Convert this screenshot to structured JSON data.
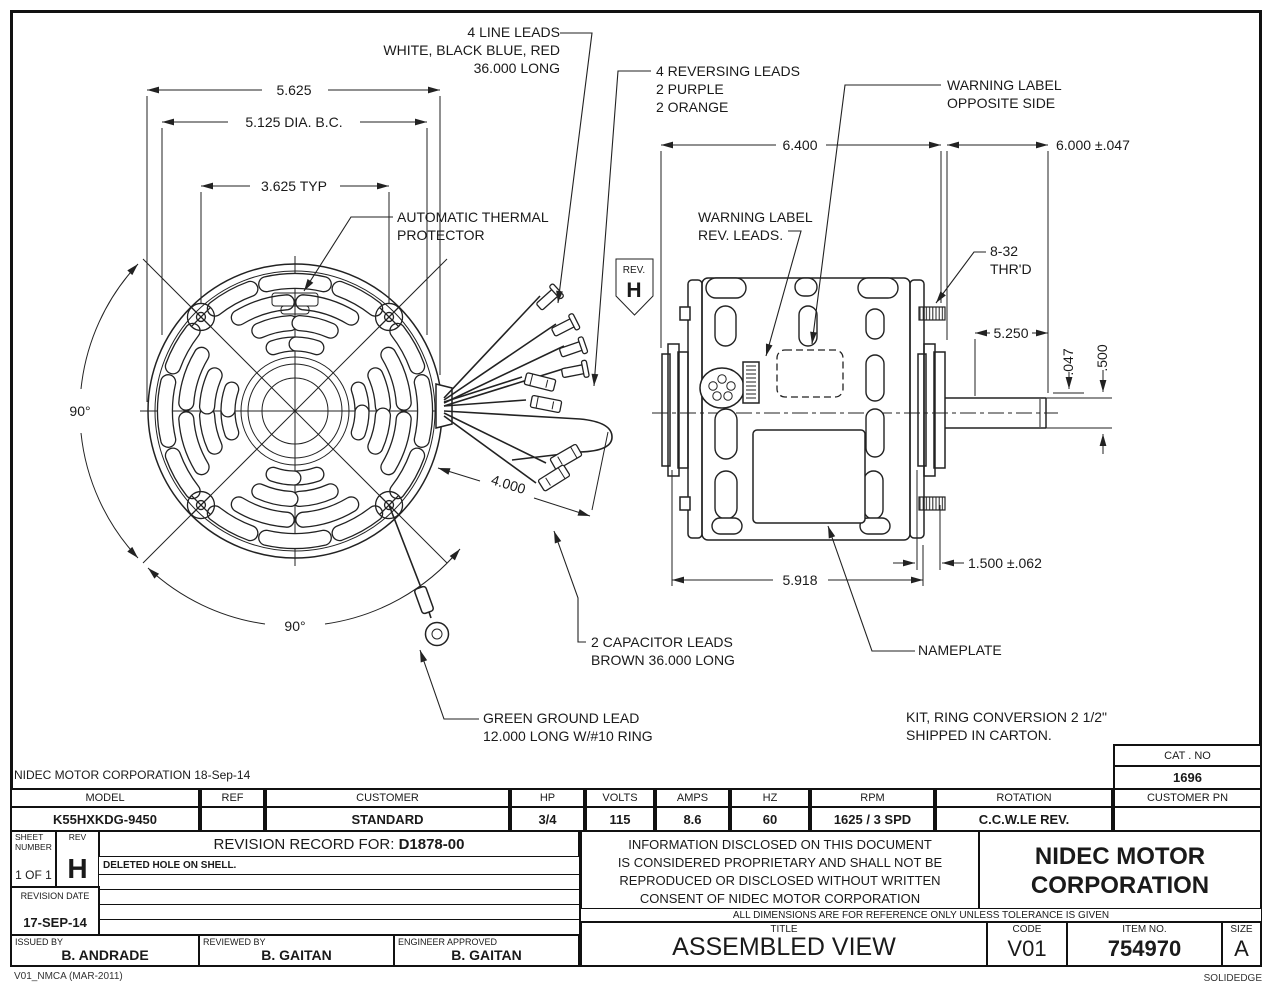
{
  "callouts": {
    "line_leads": {
      "l1": "4 LINE LEADS",
      "l2": "WHITE, BLACK BLUE, RED",
      "l3": "36.000 LONG"
    },
    "reversing_leads": {
      "l1": "4 REVERSING LEADS",
      "l2": "2 PURPLE",
      "l3": "2 ORANGE"
    },
    "warning_opposite": {
      "l1": "WARNING LABEL",
      "l2": "OPPOSITE SIDE"
    },
    "warning_rev": {
      "l1": "WARNING LABEL",
      "l2": "REV. LEADS."
    },
    "thermal": {
      "l1": "AUTOMATIC THERMAL",
      "l2": "PROTECTOR"
    },
    "thread": {
      "l1": "8-32",
      "l2": "THR'D"
    },
    "capacitor": {
      "l1": "2 CAPACITOR LEADS",
      "l2": "BROWN 36.000 LONG"
    },
    "ground": {
      "l1": "GREEN GROUND LEAD",
      "l2": "12.000 LONG W/#10 RING"
    },
    "nameplate": "NAMEPLATE",
    "kit": {
      "l1": "KIT, RING CONVERSION 2 1/2\"",
      "l2": "SHIPPED IN CARTON."
    },
    "rev_flag": {
      "label": "REV.",
      "value": "H"
    }
  },
  "dimensions": {
    "front_width": "5.625",
    "bolt_circle": "5.125  DIA. B.C.",
    "bolt_chord": "3.625  TYP",
    "angle_left": "90°",
    "angle_bottom": "90°",
    "lead_exit": "4.000",
    "body_length": "6.400",
    "overall_length": "6.000 ±.047",
    "shaft_ext": "5.250",
    "shoulder": ".047",
    "shaft_dia": ".500",
    "stud_length": "1.500 ±.062",
    "shell_length": "5.918"
  },
  "titleblock": {
    "corp_line": "NIDEC MOTOR CORPORATION 18-Sep-14",
    "cat_no": {
      "label": "CAT . NO",
      "value": "1696"
    },
    "spec": {
      "headers": [
        "MODEL",
        "REF",
        "CUSTOMER",
        "HP",
        "VOLTS",
        "AMPS",
        "HZ",
        "RPM",
        "ROTATION",
        "CUSTOMER PN"
      ],
      "values": [
        "K55HXKDG-9450",
        "",
        "STANDARD",
        "3/4",
        "115",
        "8.6",
        "60",
        "1625 / 3 SPD",
        "C.C.W.LE REV.",
        ""
      ]
    },
    "revision": {
      "sheet_label": "SHEET\nNUMBER",
      "sheet_value": "1 OF 1",
      "rev_label": "REV",
      "rev_value": "H",
      "header_label": "REVISION RECORD FOR:",
      "header_value": "D1878-00",
      "row1": "DELETED HOLE ON SHELL.",
      "date_label": "REVISION DATE",
      "date_value": "17-SEP-14"
    },
    "signoff": {
      "issued_label": "ISSUED BY",
      "issued": "B. ANDRADE",
      "reviewed_label": "REVIEWED BY",
      "reviewed": "B. GAITAN",
      "approved_label": "ENGINEER APPROVED",
      "approved": "B. GAITAN"
    },
    "legal": {
      "l1": "INFORMATION DISCLOSED ON THIS DOCUMENT",
      "l2": "IS CONSIDERED PROPRIETARY AND SHALL NOT BE",
      "l3": "REPRODUCED OR DISCLOSED WITHOUT WRITTEN",
      "l4": "CONSENT OF NIDEC MOTOR CORPORATION"
    },
    "company": {
      "l1": "NIDEC MOTOR",
      "l2": "CORPORATION"
    },
    "tolerance_note": "ALL DIMENSIONS ARE FOR REFERENCE ONLY UNLESS TOLERANCE IS GIVEN",
    "title_cell": {
      "label": "TITLE",
      "value": "ASSEMBLED VIEW"
    },
    "code_cell": {
      "label": "CODE",
      "value": "V01"
    },
    "item_cell": {
      "label": "ITEM NO.",
      "value": "754970"
    },
    "size_cell": {
      "label": "SIZE",
      "value": "A"
    }
  },
  "footer": {
    "left": "V01_NMCA (MAR-2011)",
    "right": "SOLIDEDGE"
  }
}
